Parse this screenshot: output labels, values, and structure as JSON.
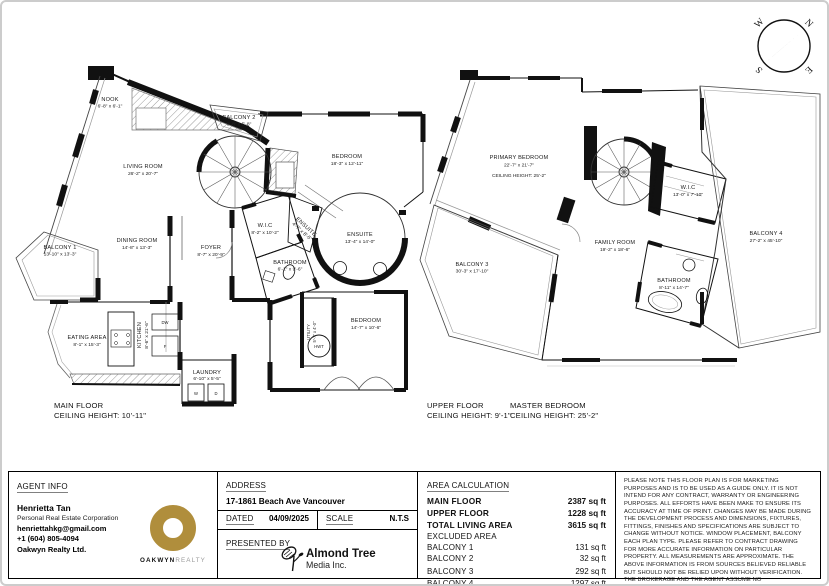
{
  "compass": {
    "w": "W",
    "n": "N",
    "s": "S",
    "e": "E"
  },
  "main_floor": {
    "title": "MAIN FLOOR",
    "ceiling": "CEILING HEIGHT: 10'-11\"",
    "rooms": {
      "nook": {
        "name": "NOOK",
        "dims": "6'-8\" x 6'-1\""
      },
      "balcony2": {
        "name": "BALCONY 2",
        "dims": "8'-8\" x 5'-8\""
      },
      "living": {
        "name": "LIVING ROOM",
        "dims": "26'-2\" x 20'-7\""
      },
      "bedroom1": {
        "name": "BEDROOM",
        "dims": "18'-3\" x 12'-11\""
      },
      "dining": {
        "name": "DINING ROOM",
        "dims": "14'-8\" x 13'-3\""
      },
      "foyer": {
        "name": "FOYER",
        "dims": "8'-7\" x 20'-9\""
      },
      "wic": {
        "name": "W.I.C",
        "dims": "8'-2\" x 10'-2\""
      },
      "ensuite_small": {
        "name": "ENSUITE",
        "dims": "4'-7\" x 8'-5\""
      },
      "bathroom": {
        "name": "BATHROOM",
        "dims": "6'-1\" x 9'-6\""
      },
      "ensuite": {
        "name": "ENSUITE",
        "dims": "13'-4\" x 14'-0\""
      },
      "balcony1": {
        "name": "BALCONY 1",
        "dims": "13'-10\" x 13'-3\""
      },
      "eating": {
        "name": "EATING AREA",
        "dims": "8'-1\" x 15'-3\""
      },
      "kitchen": {
        "name": "KITCHEN",
        "dims": "8'-6\" x 21'-6\""
      },
      "laundry": {
        "name": "LAUNDRY",
        "dims": "6'-10\" x 5'-5\""
      },
      "bedroom2": {
        "name": "BEDROOM",
        "dims": "14'-7\" x 10'-6\""
      },
      "utility": {
        "name": "UTILITY",
        "dims": "5'-7\" x 4'-0\""
      }
    },
    "appliances": {
      "hwt": "HWT",
      "dw": "DW",
      "f": "F",
      "w": "W",
      "d": "D"
    }
  },
  "upper_floor": {
    "title": "UPPER FLOOR",
    "ceiling": "CEILING HEIGHT: 9'-1\"",
    "master_title": "MASTER BEDROOM",
    "master_ceiling": "CEILING HEIGHT: 25'-2\"",
    "rooms": {
      "primary": {
        "name": "PRIMARY BEDROOM",
        "dims": "22'-7\" x 21'-7\"",
        "ceiling": "CEILING HEIGHT: 25'-2\""
      },
      "wic": {
        "name": "W.I.C",
        "dims": "13'-0\" x 7'-10\""
      },
      "family": {
        "name": "FAMILY ROOM",
        "dims": "19'-2\" x 18'-6\""
      },
      "balcony3": {
        "name": "BALCONY 3",
        "dims": "30'-3\" x 17'-10\""
      },
      "balcony4": {
        "name": "BALCONY 4",
        "dims": "27'-2\" x 45'-10\""
      },
      "bathroom": {
        "name": "BATHROOM",
        "dims": "8'-11\" x 14'-7\""
      }
    }
  },
  "footer": {
    "agent": {
      "header": "AGENT INFO",
      "name": "Henrietta Tan",
      "title": "Personal Real Estate Corporation",
      "email": "henriettahkg@gmail.com",
      "phone": "+1 (604) 805-4094",
      "company": "Oakwyn Realty Ltd.",
      "logo_main": "OAKWYN",
      "logo_sub": "REALTY"
    },
    "address": {
      "header": "ADDRESS",
      "value": "17-1861 Beach Ave Vancouver"
    },
    "dated": {
      "label": "DATED",
      "value": "04/09/2025"
    },
    "scale": {
      "label": "SCALE",
      "value": "N.T.S"
    },
    "presented": {
      "label": "PRESENTED BY",
      "logo_name": "Almond Tree",
      "logo_sub": "Media Inc."
    },
    "area": {
      "header": "AREA CALCULATION",
      "rows": [
        {
          "label": "MAIN FLOOR",
          "value": "2387 sq ft"
        },
        {
          "label": "UPPER FLOOR",
          "value": "1228 sq ft"
        },
        {
          "label": "TOTAL LIVING AREA",
          "value": "3615 sq ft"
        },
        {
          "label": "EXCLUDED AREA",
          "value": ""
        },
        {
          "label": "BALCONY 1",
          "value": "131 sq ft"
        },
        {
          "label": "BALCONY 2",
          "value": "32 sq ft"
        },
        {
          "label": "BALCONY 3",
          "value": "292 sq ft"
        },
        {
          "label": "BALCONY 4",
          "value": "1297 sq ft"
        }
      ]
    },
    "disclaimer": "PLEASE NOTE THIS FLOOR PLAN IS FOR MARKETING PURPOSES AND IS TO BE USED AS A GUIDE ONLY. IT IS NOT INTEND FOR ANY CONTRACT, WARRANTY OR ENGINEERING PURPOSES. ALL EFFORTS HAVE BEEN MAKE TO ENSURE ITS ACCURACY AT TIME OF PRINT. CHANGES MAY BE MADE DURING THE DEVELOPMENT PROCESS AND DIMENSIONS, FIXTURES, FITTINGS, FINISHES AND SPECIFICATIONS ARE SUBJECT TO CHANGE WITHOUT NOTICE. WINDOW PLACEMENT, BALCONY EACH PLAN TYPE. PLEASE REFER TO CONTRACT DRAWING FOR MORE ACCURATE INFORMATION ON PARTICULAR PROPERTY. ALL MEASUREMENTS ARE APPROXIMATE. THE ABOVE INFORMATION IS FROM SOURCES BELIEVED RELIABLE BUT SHOULD NOT BE RELIED UPON WITHOUT VERIFICATION. THE BROKERAGE AND THE AGENT ASSUME NO RESPONSIBILITY FOR ITS ACCURACY"
  }
}
